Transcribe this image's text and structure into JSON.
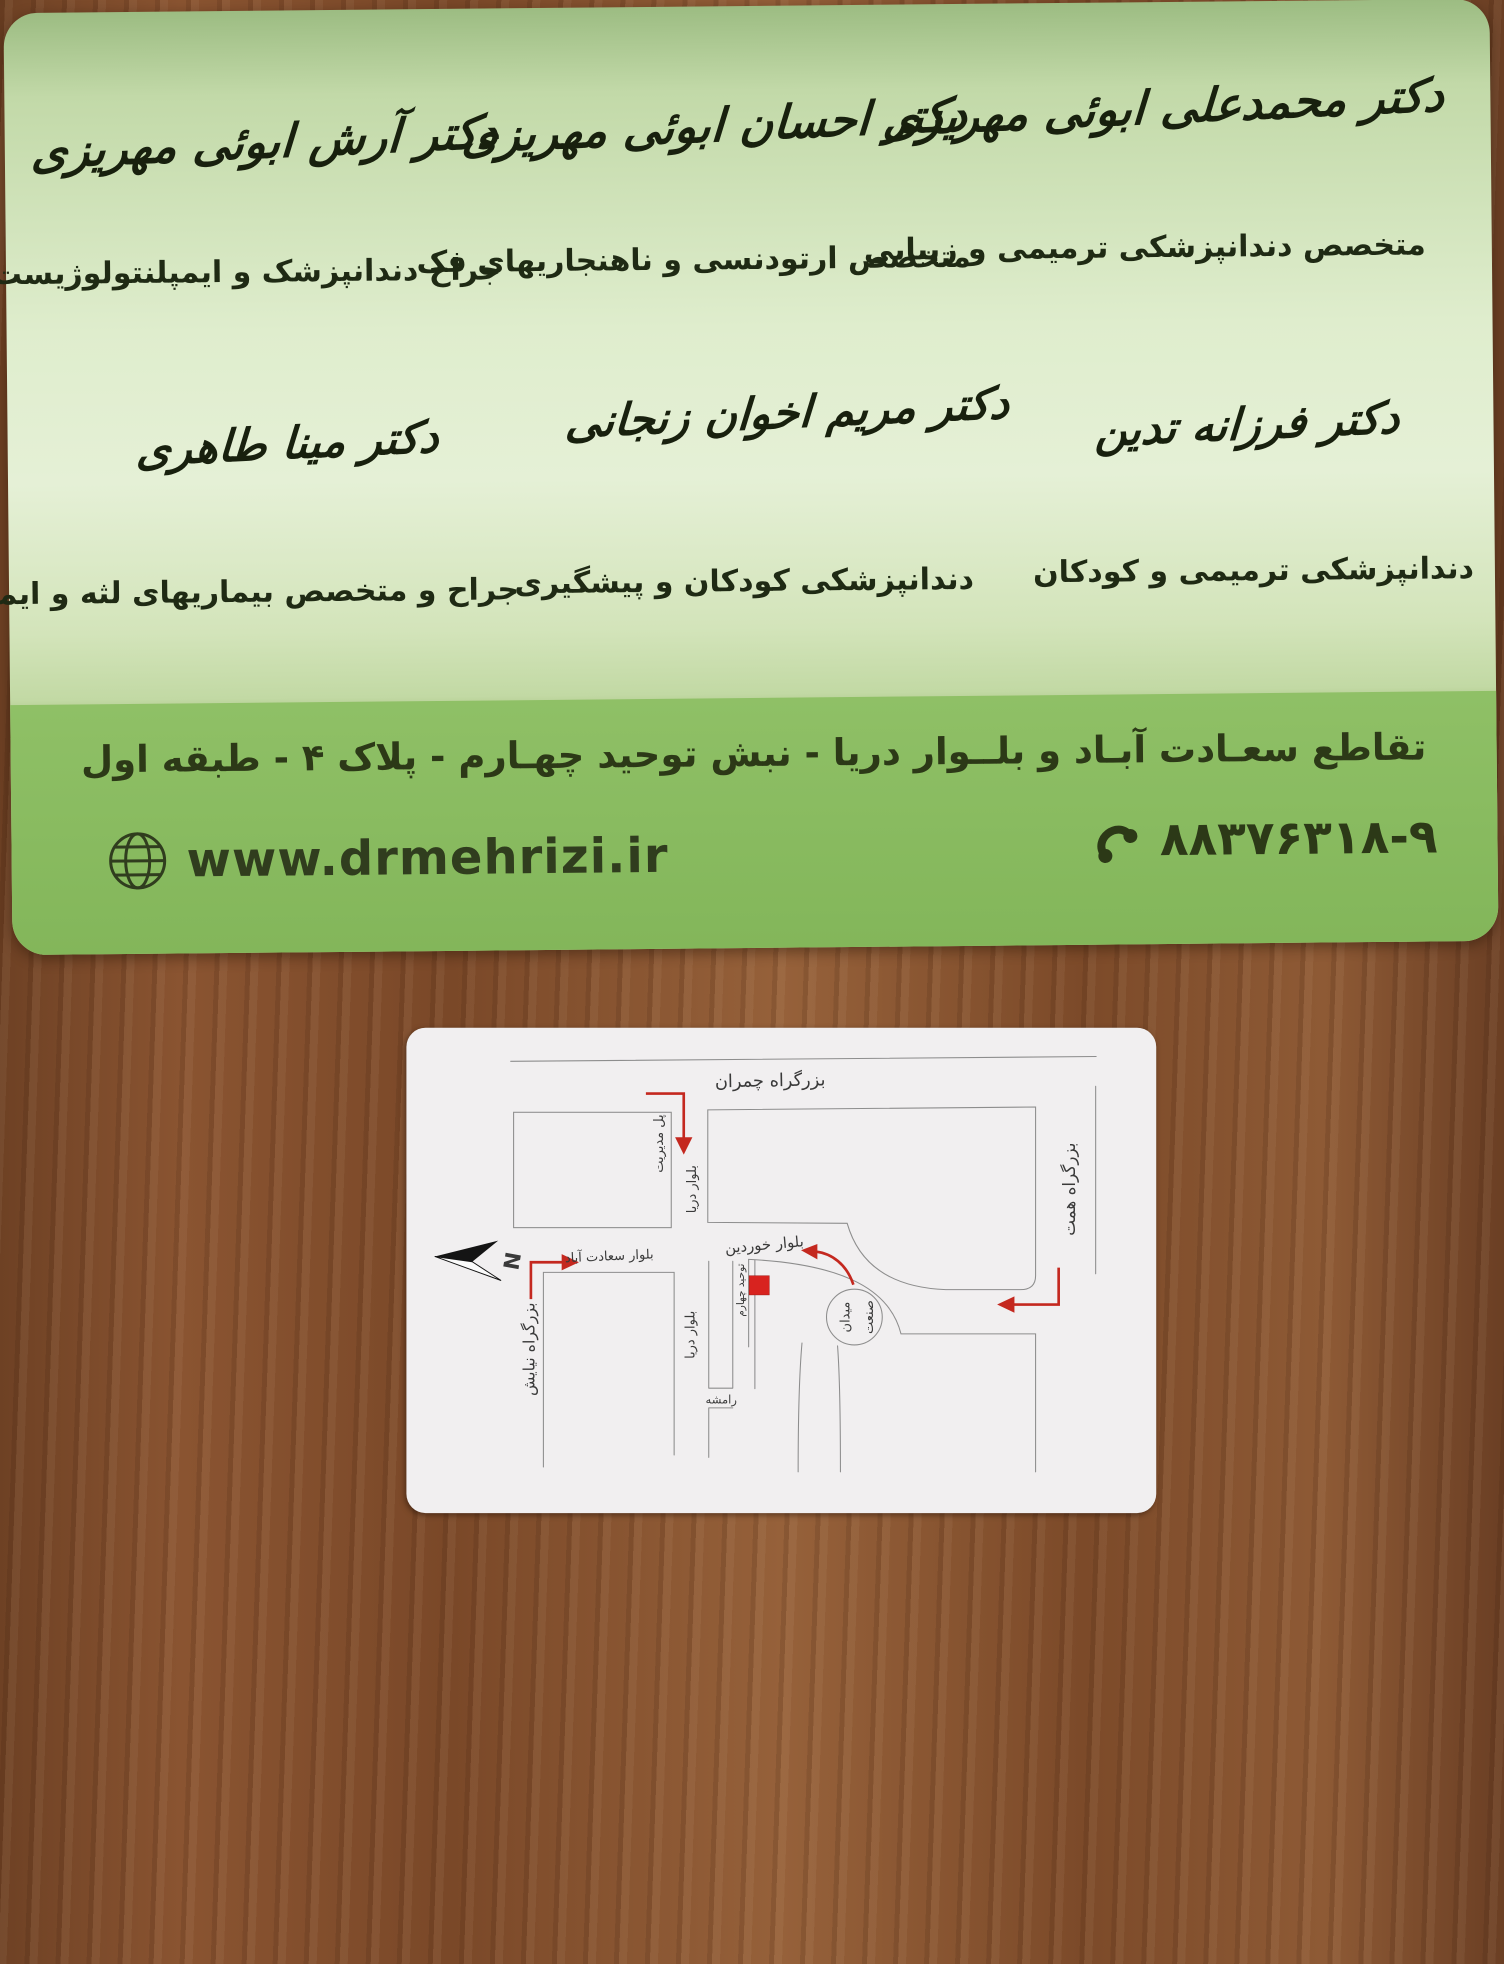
{
  "green_card": {
    "doctors_row1": [
      {
        "name": "دکتر محمدعلی ابوئی مهریزی",
        "specialty": "متخصص دندانپزشکی ترمیمی و زیبایی"
      },
      {
        "name": "دکتر احسان ابوئی مهریزی",
        "specialty": "متخصص ارتودنسی و ناهنجاریهای فک"
      },
      {
        "name": "دکتر آرش ابوئی مهریزی",
        "specialty": "جراح دندانپزشک و ایمپلنتولوژیست"
      }
    ],
    "doctors_row2": [
      {
        "name": "دکتر فرزانه تدین",
        "specialty": "دندانپزشکی ترمیمی و کودکان"
      },
      {
        "name": "دکتر مریم اخوان زنجانی",
        "specialty": "دندانپزشکی کودکان و پیشگیری"
      },
      {
        "name": "دکتر مینا طاهری",
        "specialty": "جراح و متخصص بیماریهای لثه و ایمپلنت"
      }
    ],
    "address": "تقاطع سعـادت آبـاد و بلــوار دریا - نبش توحید چهـارم - پلاک ۴ - طبقه اول",
    "website": "www.drmehrizi.ir",
    "phone": "۸۸۳۷۶۳۱۸-۹",
    "icons": {
      "globe": "globe-icon",
      "phone": "phone-handset-icon"
    }
  },
  "map_card": {
    "compass_label": "N",
    "labels": {
      "chamran": "بزرگراه چمران",
      "hemmat": "بزرگراه همت",
      "niayesh": "بزرگراه نیایش",
      "saadat_abad": "بلوار سعادت آباد",
      "darya_top": "بلوار دریا",
      "darya_bottom": "بلوار دریا",
      "khordin": "بلوار خوردین",
      "modiriat_bridge": "پل مدیریت",
      "tohid_4": "توحید چهارم",
      "sanat_square_word1": "میدان",
      "sanat_square_word2": "صنعت",
      "ramsheh": "رامشه"
    },
    "marker": "clinic-location-red-square"
  },
  "colors": {
    "band_green": "#87b95f",
    "card_light_green": "#e3efd2",
    "accent_red": "#c4281f",
    "map_line_gray": "#8d8d8d",
    "wood_brown": "#8a5431"
  }
}
